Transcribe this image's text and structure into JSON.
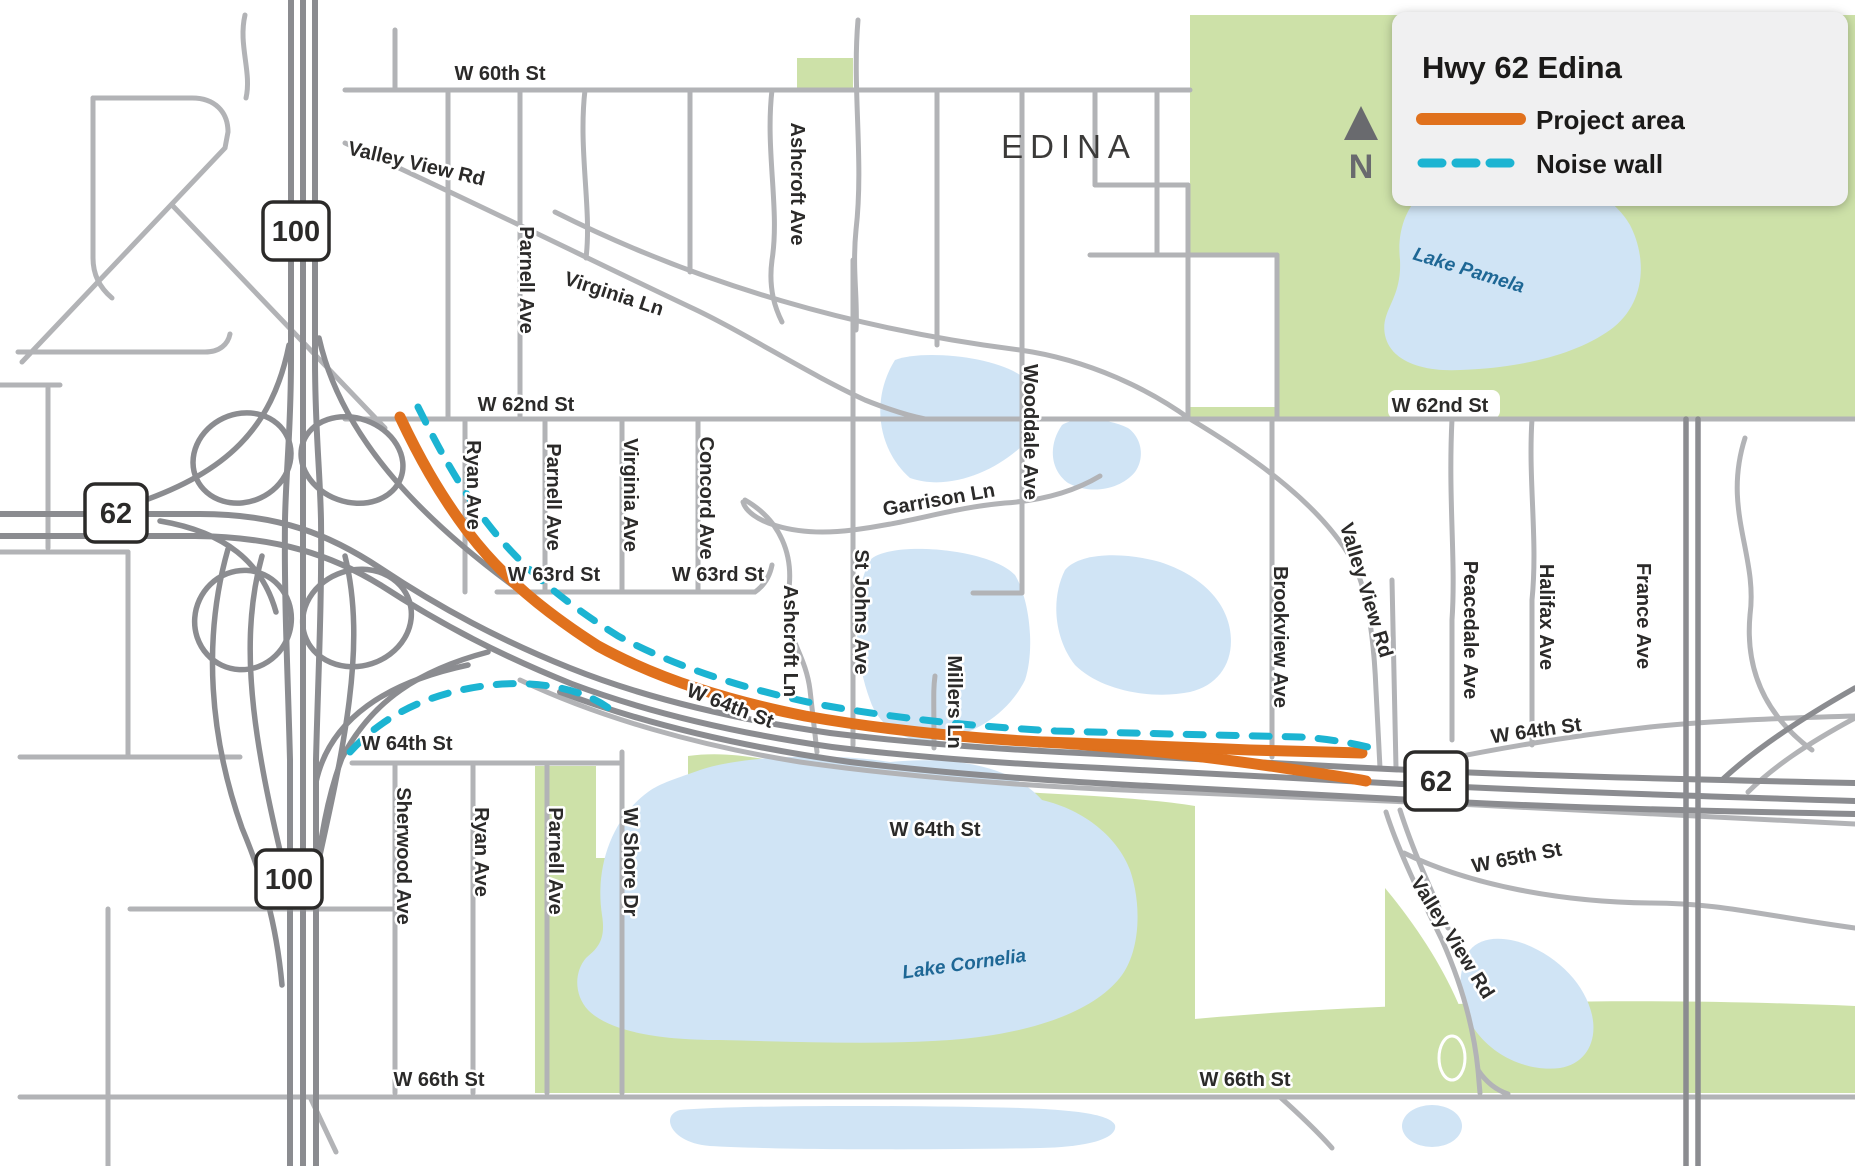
{
  "legend": {
    "title": "Hwy 62 Edina",
    "items": [
      {
        "label": "Project area",
        "style": "solid-orange"
      },
      {
        "label": "Noise wall",
        "style": "dashed-teal"
      }
    ],
    "north_label": "N"
  },
  "city_label": "EDINA",
  "shields": [
    {
      "route": "100",
      "position": "north"
    },
    {
      "route": "62",
      "position": "west"
    },
    {
      "route": "100",
      "position": "south"
    },
    {
      "route": "62",
      "position": "east"
    }
  ],
  "map_labels": [
    {
      "id": "w60th",
      "text": "W 60th St",
      "kind": "street"
    },
    {
      "id": "vv_top",
      "text": "Valley View Rd",
      "kind": "street"
    },
    {
      "id": "parnell_top",
      "text": "Parnell Ave",
      "kind": "street"
    },
    {
      "id": "virginia_ln",
      "text": "Virginia Ln",
      "kind": "street"
    },
    {
      "id": "ashcroft_ave",
      "text": "Ashcroft Ave",
      "kind": "street"
    },
    {
      "id": "w62nd_l",
      "text": "W 62nd St",
      "kind": "street"
    },
    {
      "id": "w62nd_r",
      "text": "W 62nd St",
      "kind": "street"
    },
    {
      "id": "ryan_mid",
      "text": "Ryan Ave",
      "kind": "street"
    },
    {
      "id": "parnell_mid",
      "text": "Parnell Ave",
      "kind": "street"
    },
    {
      "id": "virginia_ave",
      "text": "Virginia Ave",
      "kind": "street"
    },
    {
      "id": "concord",
      "text": "Concord Ave",
      "kind": "street"
    },
    {
      "id": "w63rd_l",
      "text": "W 63rd St",
      "kind": "street"
    },
    {
      "id": "w63rd_r",
      "text": "W 63rd St",
      "kind": "street"
    },
    {
      "id": "garrison",
      "text": "Garrison Ln",
      "kind": "street"
    },
    {
      "id": "wooddale",
      "text": "Wooddale Ave",
      "kind": "street"
    },
    {
      "id": "ashcroft_ln",
      "text": "Ashcroft Ln",
      "kind": "street"
    },
    {
      "id": "stjohns",
      "text": "St Johns Ave",
      "kind": "street"
    },
    {
      "id": "millers",
      "text": "Millers Ln",
      "kind": "street"
    },
    {
      "id": "w64th_corridor",
      "text": "W 64th St",
      "kind": "street"
    },
    {
      "id": "w64th_l",
      "text": "W 64th St",
      "kind": "street"
    },
    {
      "id": "brookview",
      "text": "Brookview Ave",
      "kind": "street"
    },
    {
      "id": "vv_mid",
      "text": "Valley View Rd",
      "kind": "street"
    },
    {
      "id": "peacedale",
      "text": "Peacedale Ave",
      "kind": "street"
    },
    {
      "id": "halifax",
      "text": "Halifax Ave",
      "kind": "street"
    },
    {
      "id": "france",
      "text": "France Ave",
      "kind": "street"
    },
    {
      "id": "w64th_green",
      "text": "W 64th St",
      "kind": "street"
    },
    {
      "id": "w64th_r",
      "text": "W 64th St",
      "kind": "street"
    },
    {
      "id": "w65th",
      "text": "W 65th St",
      "kind": "street"
    },
    {
      "id": "sherwood",
      "text": "Sherwood Ave",
      "kind": "street"
    },
    {
      "id": "ryan_bot",
      "text": "Ryan Ave",
      "kind": "street"
    },
    {
      "id": "parnell_bot",
      "text": "Parnell Ave",
      "kind": "street"
    },
    {
      "id": "wshore",
      "text": "W Shore Dr",
      "kind": "street"
    },
    {
      "id": "vv_bot",
      "text": "Valley View Rd",
      "kind": "street"
    },
    {
      "id": "w66th_l",
      "text": "W 66th St",
      "kind": "street"
    },
    {
      "id": "w66th_r",
      "text": "W 66th St",
      "kind": "street"
    },
    {
      "id": "pamela",
      "text": "Lake Pamela",
      "kind": "lake"
    },
    {
      "id": "cornelia",
      "text": "Lake Cornelia",
      "kind": "lake"
    }
  ],
  "colors": {
    "road-light": "#b2b3b6",
    "road-dark": "#8b8c90",
    "park": "#cde1a8",
    "water": "#d0e4f5",
    "proj": "#e0711d",
    "wall": "#1cb4d2",
    "ink": "#2b2a29",
    "lake-ink": "#1e6795",
    "legend-bg": "#f0f0f1",
    "north": "#696a6e"
  }
}
